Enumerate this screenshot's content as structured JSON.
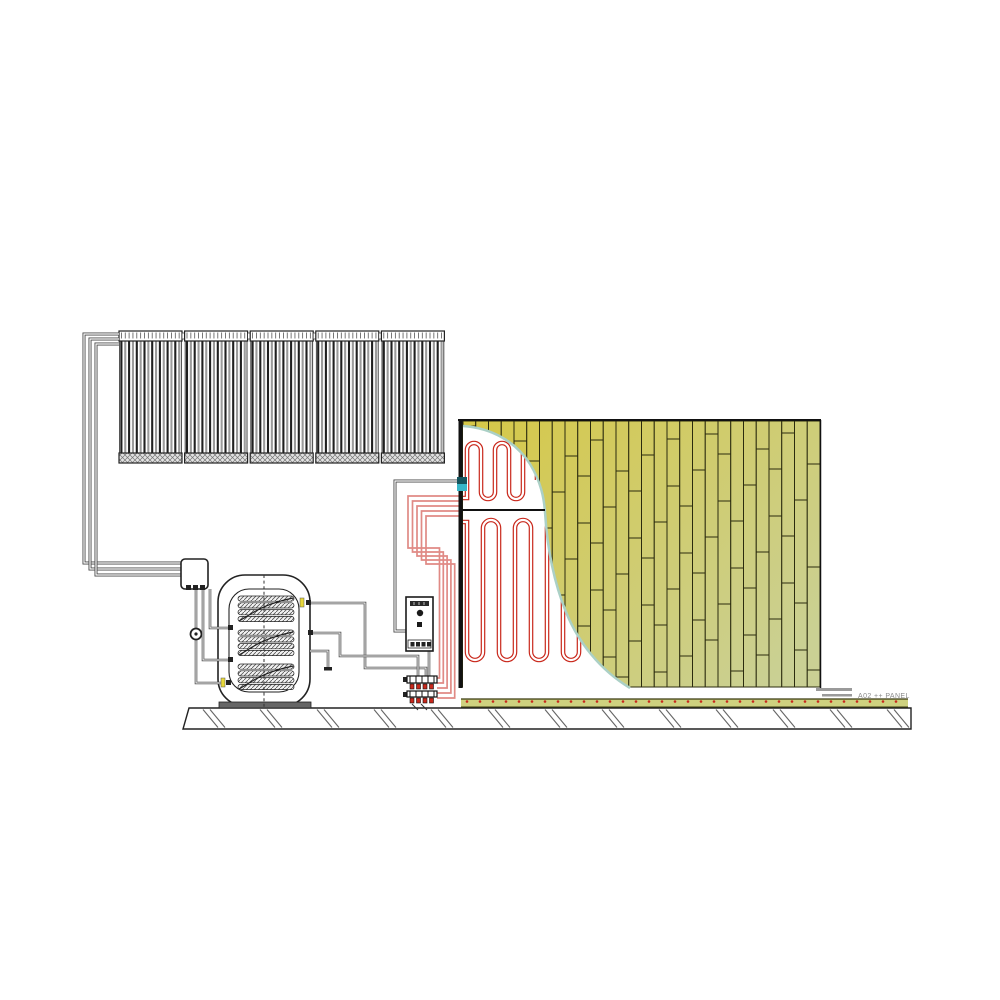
{
  "diagram": {
    "label": {
      "text": "A02 ++ PANEL"
    },
    "colors": {
      "ink": "#1a1a1a",
      "pipe": "#4a4a4a",
      "tube_dark": "#1f1f1f",
      "tube_light": "#9b9b9b",
      "red_pipe": "#c9281c",
      "red_pipe_pale": "#e08a85",
      "plank_top": "#d6c847",
      "plank_bottom": "#cad094",
      "plank_outline": "#2b2b0e",
      "cutaway_edge": "#abd0c6",
      "teal_fitting": "#37b6c8",
      "teal_fitting_dark": "#14555e",
      "floor_strip": "#ced17f",
      "floor_strip_line": "#3a3a10",
      "yellow_port": "#e8d83a",
      "leader_gray": "#9a9a9a",
      "hatch_gray": "#666666"
    },
    "collectors": {
      "count": 5,
      "tubes_per_panel": 16
    },
    "tank": {
      "coil_count": 3,
      "coil_rows": 4
    },
    "wall": {
      "plank_columns": 28,
      "upper_loops": 3,
      "lower_loops": 4
    },
    "manifold": {
      "bars": 2,
      "valves_per_bar": 4
    },
    "floor": {
      "dot_count": 34,
      "hatch_pairs": 13
    },
    "loop_bundle": {
      "lines": 5
    }
  }
}
